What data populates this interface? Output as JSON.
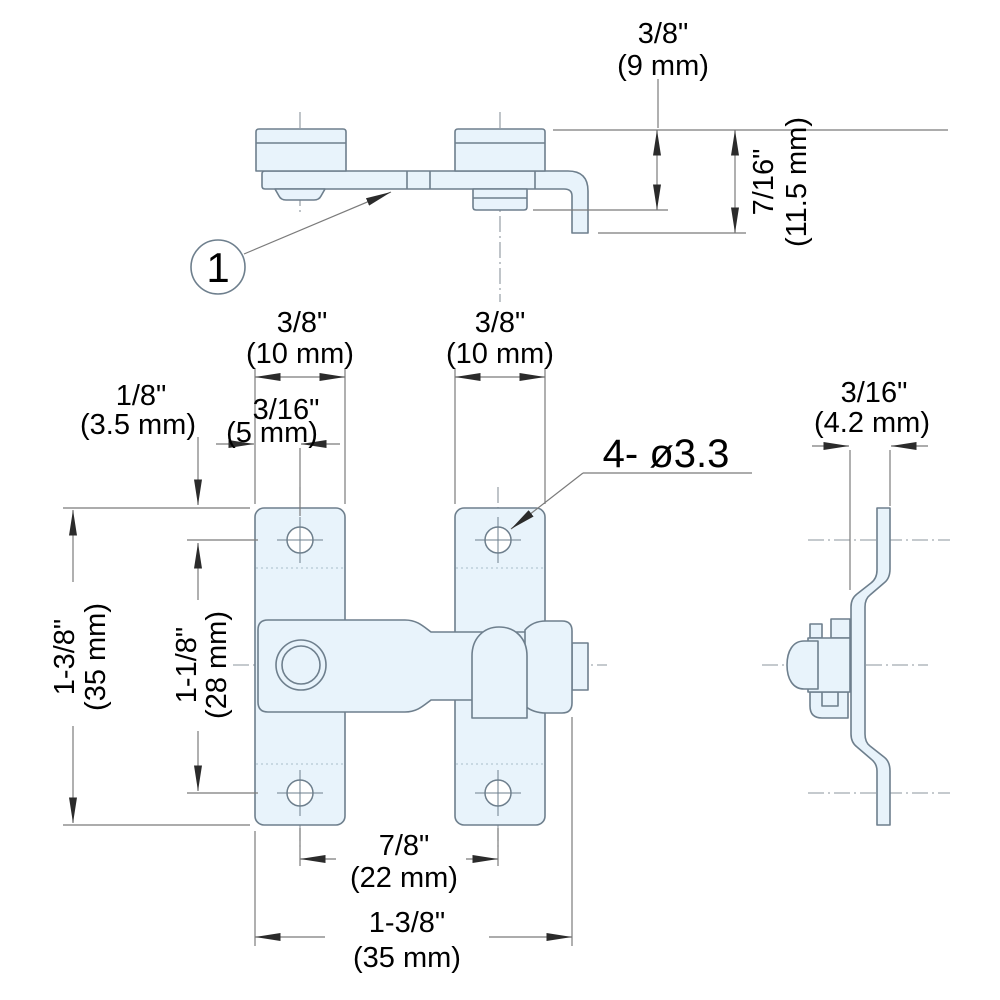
{
  "balloon": {
    "number": "1"
  },
  "hole_note": "4- ø3.3",
  "dims": {
    "knob_height": {
      "in": "3/8\"",
      "mm": "(9 mm)"
    },
    "total_depth": {
      "in": "7/16\"",
      "mm": "(11.5 mm)"
    },
    "left_plate_width": {
      "in": "3/8\"",
      "mm": "(10 mm)"
    },
    "right_plate_width": {
      "in": "3/8\"",
      "mm": "(10 mm)"
    },
    "hole_inset_top": {
      "in": "3/16\"",
      "mm": "(5 mm)"
    },
    "hole_inset_side": {
      "in": "1/8\"",
      "mm": "(3.5 mm)"
    },
    "overall_height": {
      "in": "1-3/8\"",
      "mm": "(35 mm)"
    },
    "hole_pitch_vert": {
      "in": "1-1/8\"",
      "mm": "(28 mm)"
    },
    "hole_pitch_horiz": {
      "in": "7/8\"",
      "mm": "(22 mm)"
    },
    "overall_width": {
      "in": "1-3/8\"",
      "mm": "(35 mm)"
    },
    "side_offset": {
      "in": "3/16\"",
      "mm": "(4.2 mm)"
    }
  },
  "colors": {
    "part_fill": "#e8f3fb",
    "outline": "#6e7f8d",
    "dimension_line": "#7b7b7b",
    "arrow": "#2b2b2b",
    "text": "#000000"
  }
}
